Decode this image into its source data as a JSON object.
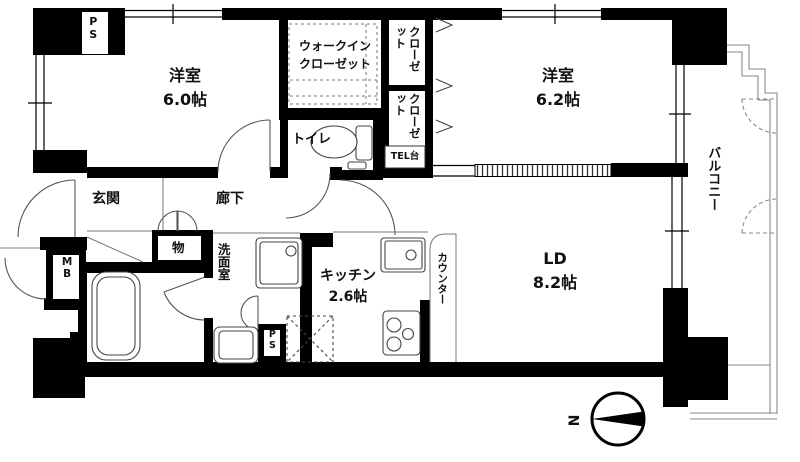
{
  "floorplan": {
    "rooms": {
      "bedroom1": {
        "name": "洋室",
        "size": "6.0帖"
      },
      "bedroom2": {
        "name": "洋室",
        "size": "6.2帖"
      },
      "living_dining": {
        "name": "LD",
        "size": "8.2帖"
      },
      "kitchen": {
        "name": "キッチン",
        "size": "2.6帖"
      },
      "entrance": {
        "name": "玄関"
      },
      "hallway": {
        "name": "廊下"
      },
      "toilet": {
        "name": "トイレ"
      },
      "washroom": {
        "name": "洗面室"
      },
      "storage": {
        "name": "物"
      },
      "walk_in_closet": {
        "line1": "ウォークイン",
        "line2": "クローゼット"
      },
      "closet_upper": {
        "name": "クローゼット"
      },
      "closet_lower": {
        "name": "クローゼット"
      },
      "balcony": {
        "name": "バルコニー"
      }
    },
    "features": {
      "counter": "カウンター",
      "tel_stand": "TEL台",
      "meter_box": "MB",
      "pipe_space_top": "PS",
      "pipe_space_bottom": "PS"
    },
    "compass": {
      "north": "N"
    },
    "colors": {
      "wall": "#000000",
      "background": "#ffffff",
      "thin_line": "#555555"
    }
  }
}
